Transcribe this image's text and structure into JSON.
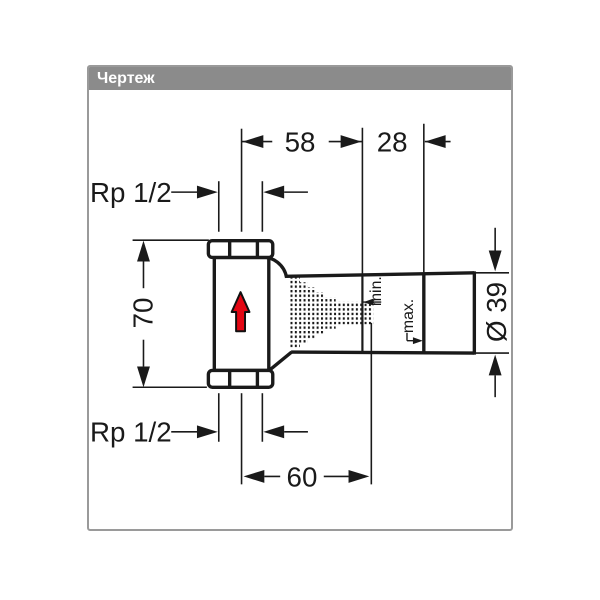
{
  "header": {
    "title": "Чертеж"
  },
  "drawing": {
    "dimensions": {
      "top_width": "58",
      "top_offset": "28",
      "height": "70",
      "bottom_width": "60",
      "diameter": "Ø 39",
      "thread_top": "Rp 1/2",
      "thread_bottom": "Rp 1/2"
    },
    "labels": {
      "min": "min.",
      "max": "max."
    },
    "colors": {
      "line": "#1a1a1a",
      "flow_arrow": "#e30613",
      "header_background": "#8b8b8b",
      "header_text": "#ffffff",
      "panel_border": "#9a9a9a"
    }
  }
}
